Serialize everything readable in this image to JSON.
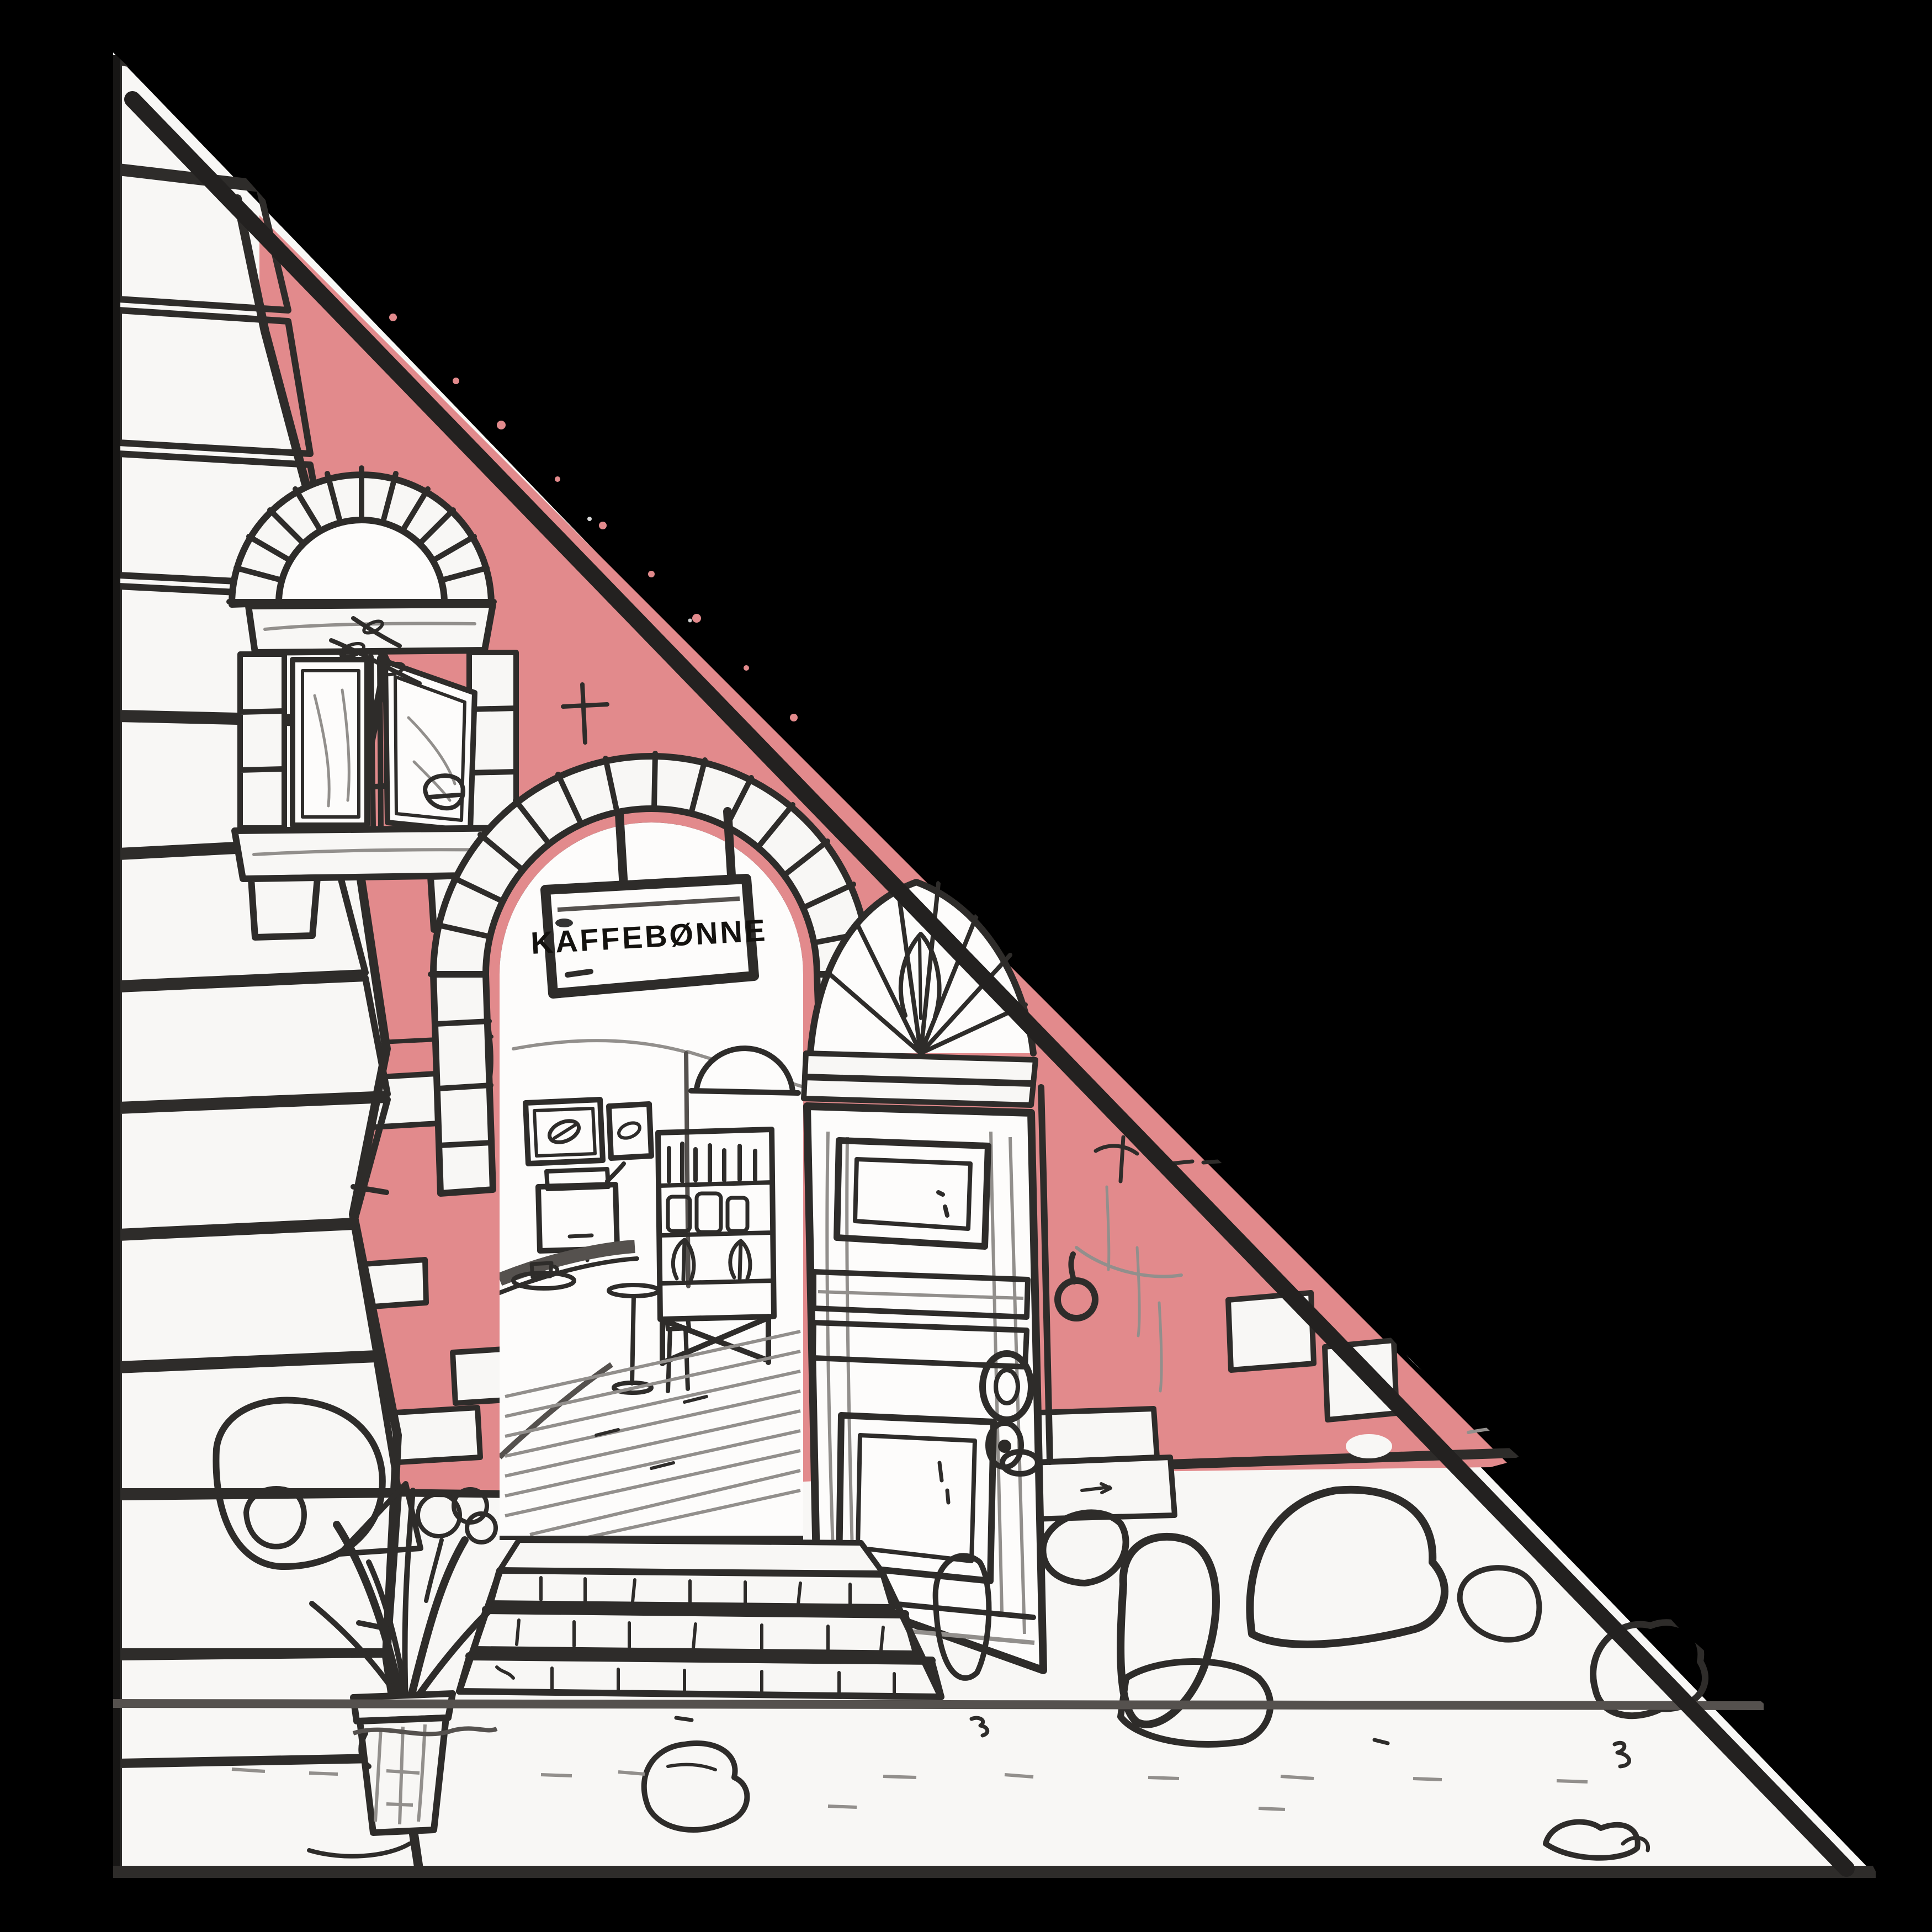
{
  "meta": {
    "description": "Hand-drawn pencil sketch of a coffee-shop entrance: stone archway with hanging sign, open wooden panel door, arched casement window, salmon-red plaster wall with exposed white bricks, rough stone pillar on the left, steps, potted plant and cobblestones on a pale street. The upper-right diagonal half of the canvas is solid black."
  },
  "sign": {
    "text": "KAFFEBØNNE"
  },
  "palette": {
    "background": "#000000",
    "paper": "#f8f7f5",
    "interior_white": "#fdfcfb",
    "wall_red": "#e28a8c",
    "pencil_dark": "#2e2c2a",
    "pencil_mid": "#55514e",
    "pencil_light": "#928f8c"
  }
}
